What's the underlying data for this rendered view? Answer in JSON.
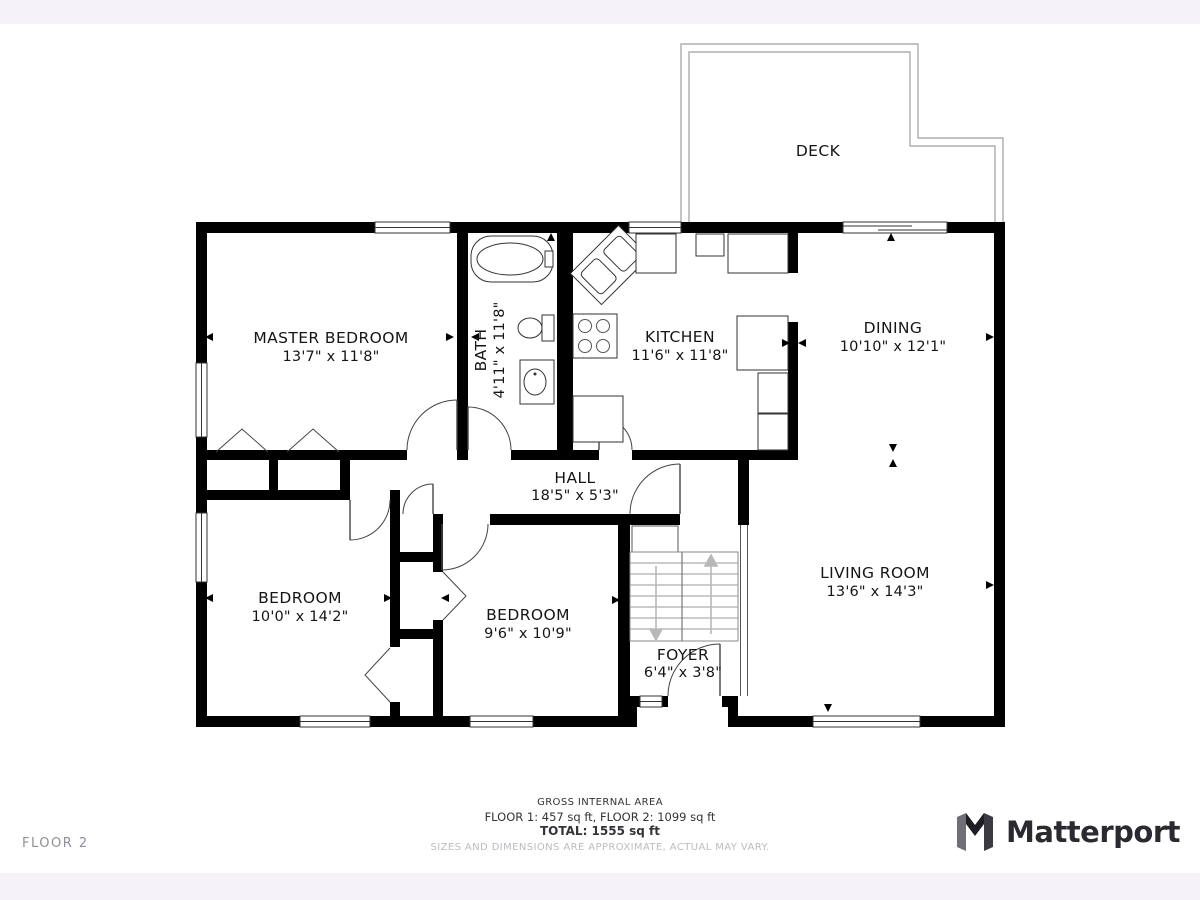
{
  "page": {
    "background": "#ffffff",
    "frame_color": "#f5f3f8",
    "wall_color": "#000000",
    "floor_label": "FLOOR 2"
  },
  "rooms": [
    {
      "name": "DECK",
      "dims": ""
    },
    {
      "name": "MASTER BEDROOM",
      "dims": "13'7\" x 11'8\""
    },
    {
      "name": "BATH",
      "dims": "4'11\" x 11'8\""
    },
    {
      "name": "KITCHEN",
      "dims": "11'6\" x 11'8\""
    },
    {
      "name": "DINING",
      "dims": "10'10\" x 12'1\""
    },
    {
      "name": "HALL",
      "dims": "18'5\" x 5'3\""
    },
    {
      "name": "BEDROOM",
      "dims": "10'0\" x 14'2\""
    },
    {
      "name": "BEDROOM",
      "dims": "9'6\" x 10'9\""
    },
    {
      "name": "FOYER",
      "dims": "6'4\" x 3'8\""
    },
    {
      "name": "LIVING ROOM",
      "dims": "13'6\" x 14'3\""
    }
  ],
  "footer": {
    "gross_title": "GROSS INTERNAL AREA",
    "floors_line": "FLOOR 1: 457 sq ft, FLOOR 2: 1099 sq ft",
    "total_line": "TOTAL: 1555 sq ft",
    "disclaimer": "SIZES AND DIMENSIONS ARE APPROXIMATE, ACTUAL MAY VARY."
  },
  "branding": {
    "name": "Matterport",
    "logo_icon": "matterport-m-logo",
    "text_color": "#2a2a30"
  },
  "icons": {
    "stairs_up": "stairs-up-arrow",
    "stairs_down": "stairs-down-arrow"
  }
}
